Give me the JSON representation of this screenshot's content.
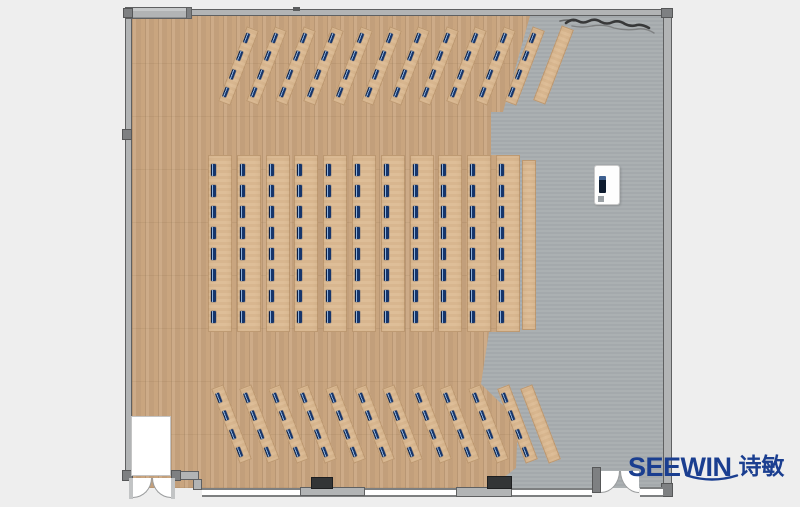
{
  "brand": {
    "name": "SEEWIN",
    "name_cn": "诗敏"
  },
  "colors": {
    "page-bg": "#eeeeee",
    "wood-floor": "#c9a57f",
    "desk": "#dcba92",
    "gray-floor": "#a8adb0",
    "wall-fill": "#b2b4b5",
    "wall-line": "#5f6061",
    "joint": "#7e8082",
    "seat-navy": "#16356b",
    "seat-light": "#8fb3dd",
    "logo-blue": "#1a3e90",
    "block-dark": "#333536"
  },
  "plan": {
    "total_seats": 176,
    "sections": [
      {
        "name": "top-desk-rows",
        "type": "tilted",
        "tilt_deg": 21,
        "strip_count": 11,
        "seats_per_strip": 4,
        "first_center_x": 238,
        "center_y": 66,
        "pitch_x": 28.6,
        "strip_w": 13,
        "strip_h": 80,
        "side_table": {
          "center_x": 553,
          "center_y": 65,
          "w": 13,
          "h": 80
        }
      },
      {
        "name": "middle-desk-rows",
        "type": "vertical",
        "tilt_deg": 0,
        "strip_count": 11,
        "seats_per_strip": 8,
        "x0": 208,
        "y": 155,
        "pitch_x": 28.8,
        "strip_w": 24,
        "strip_h": 177,
        "side_table": {
          "x": 522,
          "y": 160,
          "w": 14,
          "h": 170
        }
      },
      {
        "name": "bottom-desk-rows",
        "type": "tilted",
        "tilt_deg": -21,
        "strip_count": 11,
        "seats_per_strip": 4,
        "first_center_x": 231,
        "center_y": 424,
        "pitch_x": 28.6,
        "strip_w": 13,
        "strip_h": 80,
        "side_table": {
          "center_x": 540,
          "center_y": 424,
          "w": 13,
          "h": 80
        }
      }
    ]
  }
}
